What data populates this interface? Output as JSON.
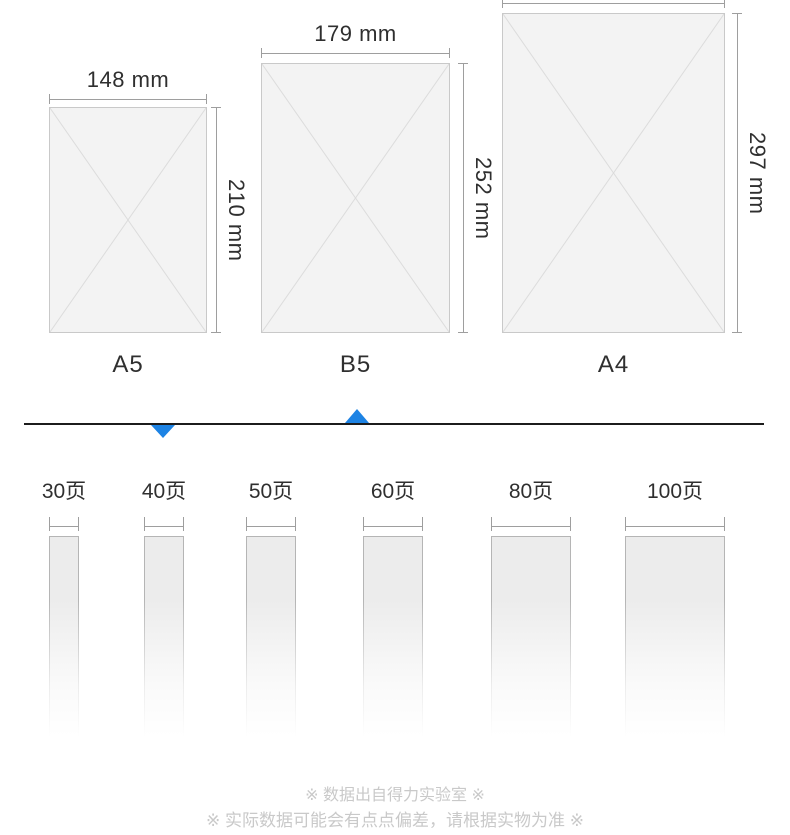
{
  "colors": {
    "accent": "#1d83e4",
    "paper-fill": "#f3f3f3",
    "paper-border": "#c9c9c9",
    "paper-cross": "#dcdcdc",
    "dim-line": "#9e9e9e",
    "text": "#2f2f2f",
    "bar-fill": "#ececec",
    "bar-border": "#b5b5b5",
    "note": "#c9c9c9",
    "divider": "#1c1c1c"
  },
  "sizes": [
    {
      "name": "A5",
      "width_label": "148 mm",
      "height_label": "210 mm"
    },
    {
      "name": "B5",
      "width_label": "179 mm",
      "height_label": "252 mm"
    },
    {
      "name": "A4",
      "height_label": "297 mm"
    }
  ],
  "page_options": [
    {
      "label": "30页"
    },
    {
      "label": "40页"
    },
    {
      "label": "50页"
    },
    {
      "label": "60页"
    },
    {
      "label": "80页"
    },
    {
      "label": "100页"
    }
  ],
  "footnotes": {
    "line1": "※ 数据出自得力实验室 ※",
    "line2": "※ 实际数据可能会有点点偏差，请根据实物为准 ※"
  }
}
